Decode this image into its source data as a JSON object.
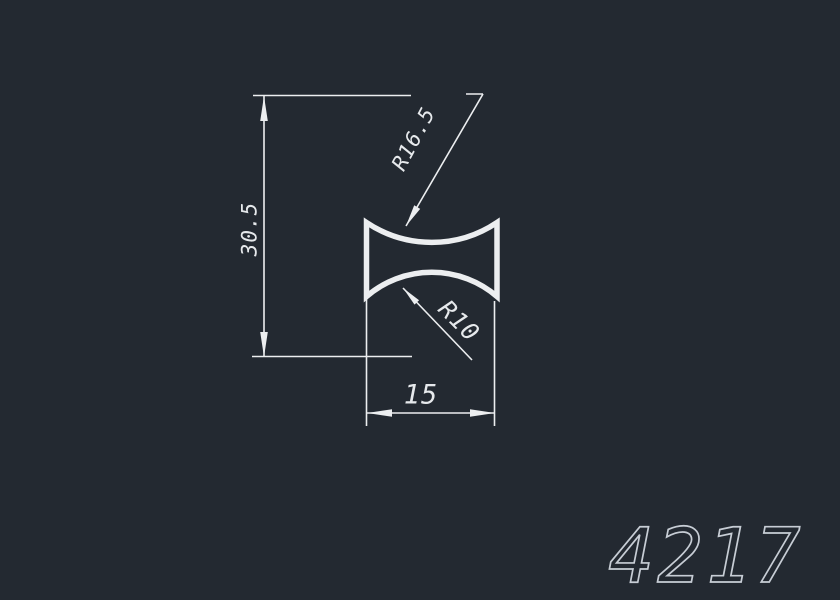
{
  "drawing": {
    "part_number": "4217",
    "dims": {
      "height": "30.5",
      "width": "15",
      "outer_radius": "R16.5",
      "inner_radius": "R10"
    },
    "colors": {
      "background": "#232931",
      "line": "#eceef0",
      "dim_text": "#e6e9ec",
      "part_number_text": "#c7cdd5"
    }
  }
}
